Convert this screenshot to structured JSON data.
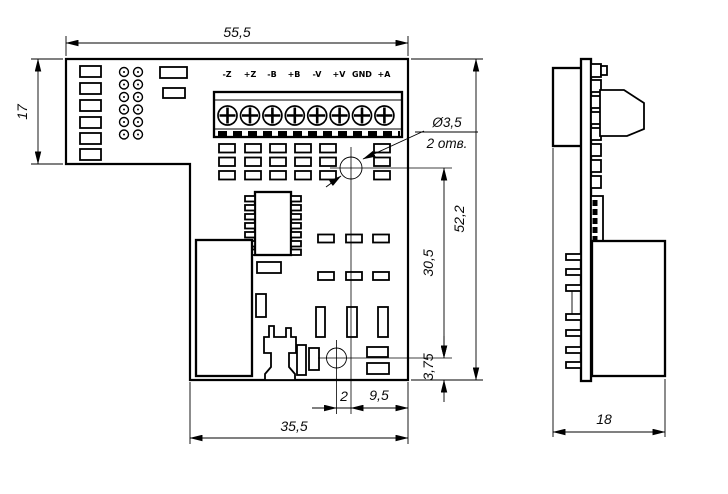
{
  "front": {
    "terminal_labels": [
      "-Z",
      "+Z",
      "-B",
      "+B",
      "-V",
      "+V",
      "GND",
      "+A"
    ],
    "dims": {
      "top_width": "55,5",
      "left_height": "17",
      "right_height": "52,2",
      "hole_span": "30,5",
      "hole_bottom_offset": "3,75",
      "hole_x_offset": "2",
      "hole_right_offset": "9,5",
      "bottom_width": "35,5"
    },
    "hole_note": {
      "diameter": "Ø3,5",
      "count": "2 отв."
    }
  },
  "side": {
    "dims": {
      "depth": "18"
    }
  },
  "colors": {
    "line": "#000000",
    "background": "#ffffff"
  }
}
